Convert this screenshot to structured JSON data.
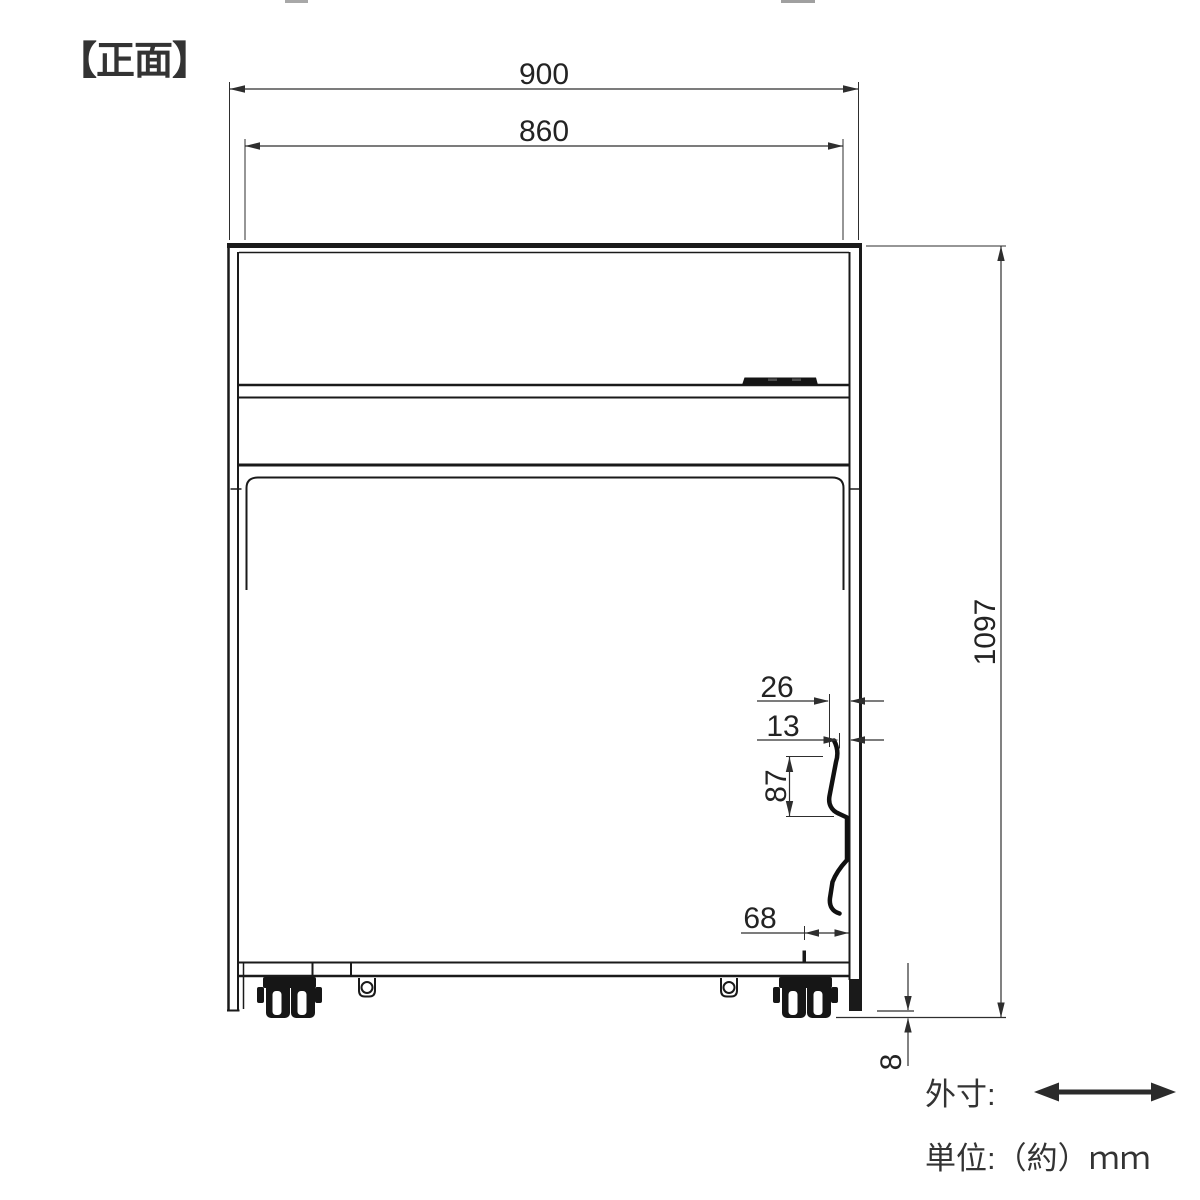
{
  "title": "【正面】",
  "dimensions": {
    "overall_width": "900",
    "inner_width": "860",
    "overall_height": "1097",
    "hook_side_offset": "26",
    "hook_tip_offset": "13",
    "hook_length": "87",
    "hook_bottom_offset": "68",
    "floor_clearance": "8"
  },
  "legend": {
    "outer_dim_label": "外寸:",
    "unit_label": "単位:（約）ｍｍ"
  },
  "colors": {
    "line": "#1a1a1a",
    "dim_line": "#2e2e2e",
    "text": "#232323"
  }
}
